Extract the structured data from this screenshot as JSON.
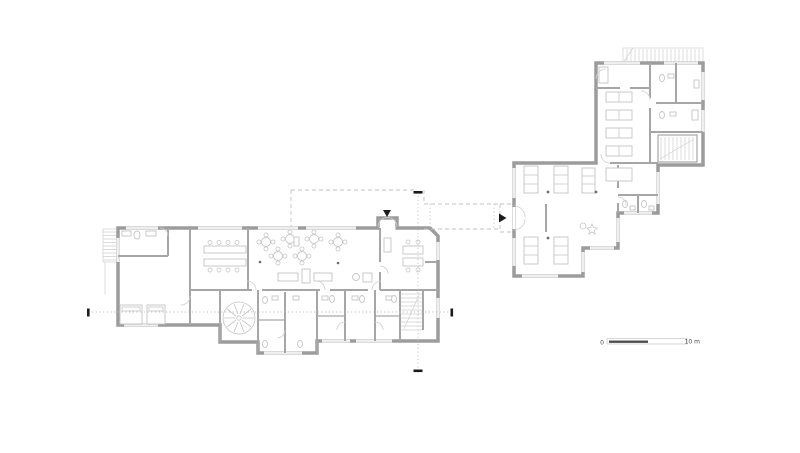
{
  "sheet": {
    "background": "#ffffff"
  },
  "scale_bar": {
    "zero_label": "0",
    "length_label": "10 m"
  },
  "colors": {
    "background": "#ffffff",
    "wall": "#9c9c9c",
    "partition": "#a6a6a6",
    "furniture": "#c5c5c5",
    "line_light": "#cfcfcf",
    "window_line": "#d2d2d2",
    "dash": "#c2c2c2",
    "mark": "#1b1b1b",
    "scale_dark": "#4f4f4f"
  }
}
